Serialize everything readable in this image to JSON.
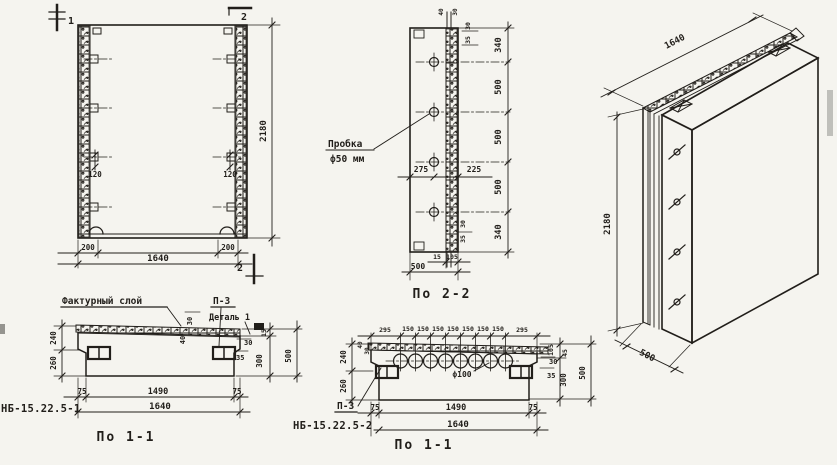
{
  "front_view": {
    "mark_1": "1",
    "mark_2_top": "2",
    "mark_2_bottom": "2",
    "dim_inset_left": "120",
    "dim_inset_right": "120",
    "dim_edge_left": "200",
    "dim_edge_right": "200",
    "dim_width": "1640",
    "dim_height": "2180"
  },
  "section_2_2": {
    "caption": "По 2-2",
    "plug_label_1": "Пробка",
    "plug_label_2": "ф50 мм",
    "dim_top_rebar": [
      "40",
      "30"
    ],
    "dim_top_right": [
      "30",
      "35"
    ],
    "dims_right": [
      "340",
      "500",
      "500",
      "500",
      "340"
    ],
    "dim_hole_left": "275",
    "dim_hole_right": "225",
    "dim_bottom_right": [
      "30",
      "35"
    ],
    "dim_bottom_small": [
      "15",
      "105"
    ],
    "dim_width": "500"
  },
  "section_1_1_left": {
    "caption": "По 1-1",
    "part_label": "НБ-15.22.5-1",
    "texture_label": "Фактурный слой",
    "p3_label": "П-3",
    "detail_label": "Деталь 1",
    "dim_layer": [
      "30",
      "40"
    ],
    "dims_left": [
      "240",
      "260"
    ],
    "dims_right_small": [
      "30",
      "35"
    ],
    "dims_right_rot": [
      "15",
      "300",
      "500"
    ],
    "dims_bottom": [
      "75",
      "1490",
      "75"
    ],
    "dim_total": "1640"
  },
  "section_1_1_mid": {
    "caption": "По 1-1",
    "part_label": "НБ-15.22.5-2",
    "p3_label": "П-3",
    "hole_label": "ф100",
    "dims_top": [
      "295",
      "150",
      "150",
      "150",
      "150",
      "150",
      "150",
      "150",
      "295"
    ],
    "dim_layer": [
      "40",
      "30"
    ],
    "dims_left": [
      "240",
      "260"
    ],
    "dims_right_small": [
      "30",
      "35"
    ],
    "dims_right_rot": [
      "105",
      "45",
      "300",
      "500"
    ],
    "dims_bottom": [
      "75",
      "1490",
      "75"
    ],
    "dim_total": "1640"
  },
  "iso_view": {
    "dim_width": "1640",
    "dim_height": "2180",
    "dim_depth": "500"
  }
}
